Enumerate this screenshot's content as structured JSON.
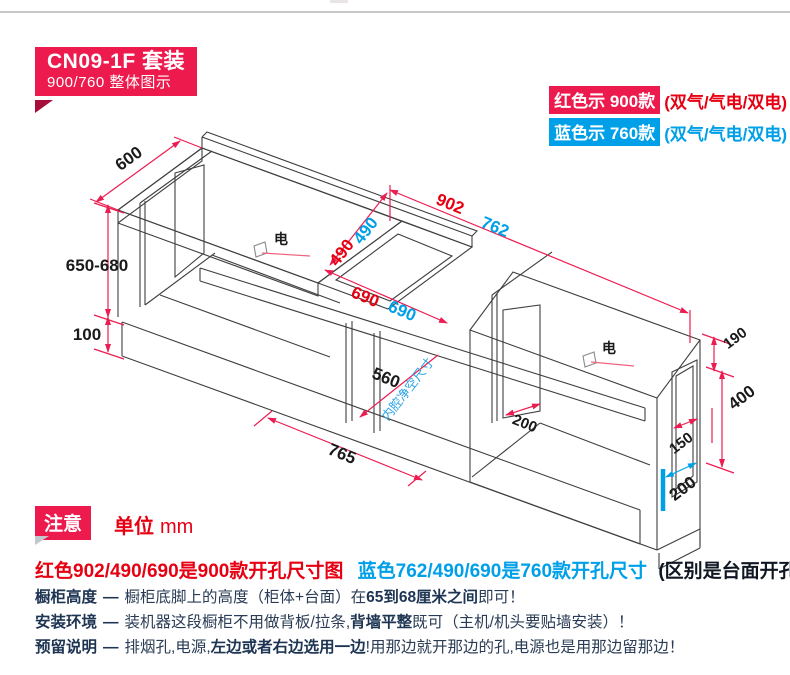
{
  "badge": {
    "line1": "CN09-1F 套装",
    "line2": "900/760 整体图示"
  },
  "legend": {
    "rows": [
      {
        "chip": "红色示 900款",
        "suffix": "(双气/气电/双电)"
      },
      {
        "chip": "蓝色示 760款",
        "suffix": "(双气/气电/双电)"
      }
    ]
  },
  "note": {
    "badge": "注意",
    "unit_label": "单位",
    "unit_value": "mm"
  },
  "headline": {
    "red": "红色902/490/690是900款开孔尺寸图",
    "blue": "蓝色762/490/690是760款开孔尺寸",
    "tail": "(区别是台面开孔尺寸不同)"
  },
  "rows": [
    {
      "label": "橱柜高度",
      "dash": "—",
      "pre": "橱柜底脚上的高度（柜体+台面）在",
      "bold": "65到68厘米之间",
      "post": "即可！"
    },
    {
      "label": "安装环境",
      "dash": "—",
      "pre": "装机器这段橱柜不用做背板/拉条,",
      "bold": "背墙平整",
      "post": "既可（主机/机头要贴墙安装）！"
    },
    {
      "label": "预留说明",
      "dash": "—",
      "pre": "排烟孔,电源,",
      "bold": "左边或者右边选用一边",
      "post": "!用那边就开那边的孔,电源也是用那边留那边！"
    }
  ],
  "dims": {
    "depth": "600",
    "cab_height": "650-680",
    "toe_kick": "100",
    "cutout_900": "902",
    "cutout_760": "762",
    "depth_900": "490",
    "depth_760": "490",
    "inner_900": "690",
    "inner_760": "690",
    "inner_depth": "560",
    "inner_note": "内腔净空尺寸",
    "front_width": "765",
    "side_hole": "200",
    "top_offset": "190",
    "side_height": "400",
    "hole_width": "150",
    "bottom_offset": "200",
    "electric_left": "电",
    "electric_right": "电"
  },
  "colors": {
    "red_accent": "#ed1a4d",
    "red_text": "#e60012",
    "blue_accent": "#00a0e9"
  }
}
